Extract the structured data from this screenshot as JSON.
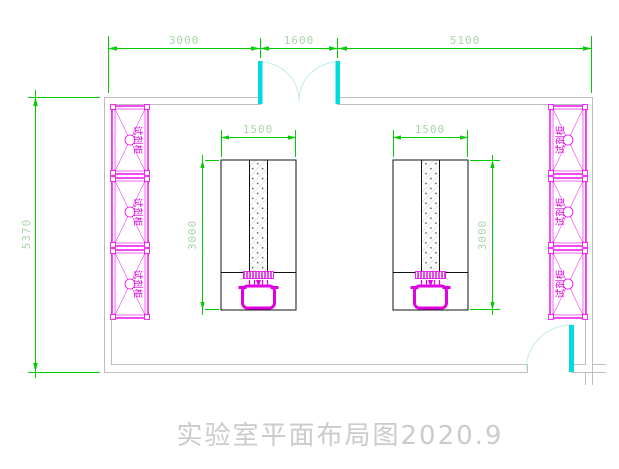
{
  "title": {
    "text": "实验室平面布局图2020.9"
  },
  "dims": {
    "top": [
      "3000",
      "1600",
      "5100"
    ],
    "left_height": "5370",
    "bench_left_width": "1500",
    "bench_right_width": "1500",
    "bench_left_depth": "3000",
    "bench_right_depth": "3000"
  },
  "cabinets": {
    "left": [
      "试剂柜",
      "试剂柜",
      "试剂柜"
    ],
    "right": [
      "试剂柜",
      "试剂柜",
      "试剂柜"
    ]
  },
  "colors": {
    "dimension_green": "#00cc00",
    "dimension_text": "#a9d6a9",
    "cabinet_magenta": "#ee00ee",
    "sink_magenta": "#e100e1",
    "door_panel_cyan": "#00dcdc",
    "door_arc_cyan": "#c2ecec",
    "wall_gray": "#bdbdbd",
    "bench_outline": "#111111",
    "title_gray": "#cbcbcb"
  }
}
